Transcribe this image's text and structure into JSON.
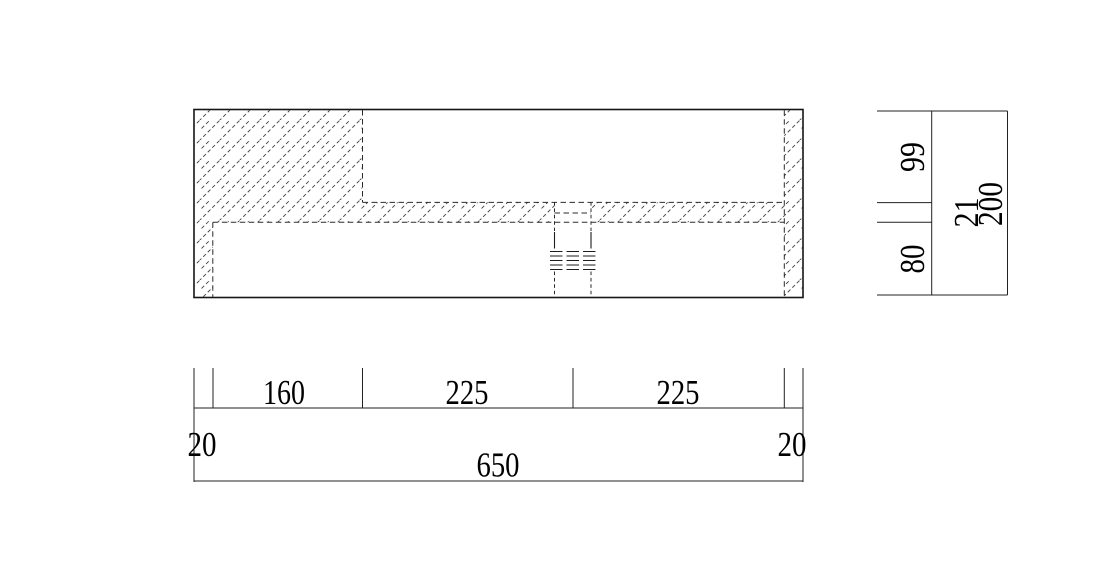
{
  "drawing": {
    "kind": "cad-section-drawing",
    "colors": {
      "line": "#1a1a1a",
      "background": "#ffffff"
    },
    "dims": {
      "bottom": {
        "segments": [
          "20",
          "160",
          "225",
          "225",
          "20"
        ],
        "total": "650"
      },
      "side": {
        "segments": [
          "99",
          "21",
          "80"
        ],
        "total": "200"
      }
    }
  }
}
